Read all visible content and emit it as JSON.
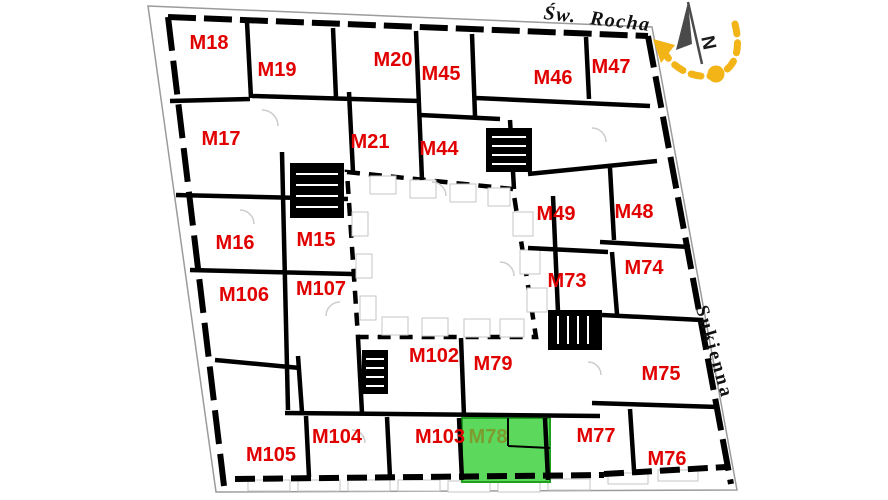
{
  "plan": {
    "streets": {
      "top": "Św. Rocha",
      "right": "Sukienna"
    },
    "compass": {
      "north_label": "N"
    },
    "colors": {
      "unit_label": "#e10000",
      "highlight_fill": "#5cd95c",
      "highlight_border": "#1fa01f",
      "highlight_label": "#7d9b2e",
      "compass_accent": "#f2b416",
      "compass_needle": "#4a4a4a",
      "wall": "#000000",
      "outline": "#9b9b9b"
    },
    "highlighted_unit": "M78",
    "units": [
      {
        "id": "M18",
        "x": 209,
        "y": 43
      },
      {
        "id": "M19",
        "x": 277,
        "y": 70
      },
      {
        "id": "M20",
        "x": 393,
        "y": 60
      },
      {
        "id": "M45",
        "x": 441,
        "y": 74
      },
      {
        "id": "M46",
        "x": 553,
        "y": 78
      },
      {
        "id": "M47",
        "x": 611,
        "y": 67
      },
      {
        "id": "M17",
        "x": 221,
        "y": 139
      },
      {
        "id": "M21",
        "x": 370,
        "y": 142
      },
      {
        "id": "M44",
        "x": 439,
        "y": 149
      },
      {
        "id": "M49",
        "x": 556,
        "y": 214
      },
      {
        "id": "M48",
        "x": 634,
        "y": 212
      },
      {
        "id": "M16",
        "x": 235,
        "y": 243
      },
      {
        "id": "M15",
        "x": 316,
        "y": 240
      },
      {
        "id": "M73",
        "x": 567,
        "y": 281
      },
      {
        "id": "M74",
        "x": 644,
        "y": 268
      },
      {
        "id": "M106",
        "x": 244,
        "y": 295
      },
      {
        "id": "M107",
        "x": 321,
        "y": 289
      },
      {
        "id": "M102",
        "x": 434,
        "y": 356
      },
      {
        "id": "M79",
        "x": 493,
        "y": 364
      },
      {
        "id": "M75",
        "x": 661,
        "y": 374
      },
      {
        "id": "M104",
        "x": 337,
        "y": 437
      },
      {
        "id": "M103",
        "x": 440,
        "y": 437
      },
      {
        "id": "M78",
        "x": 488,
        "y": 437,
        "highlighted": true
      },
      {
        "id": "M77",
        "x": 596,
        "y": 436
      },
      {
        "id": "M105",
        "x": 271,
        "y": 455
      },
      {
        "id": "M76",
        "x": 667,
        "y": 459
      }
    ]
  }
}
